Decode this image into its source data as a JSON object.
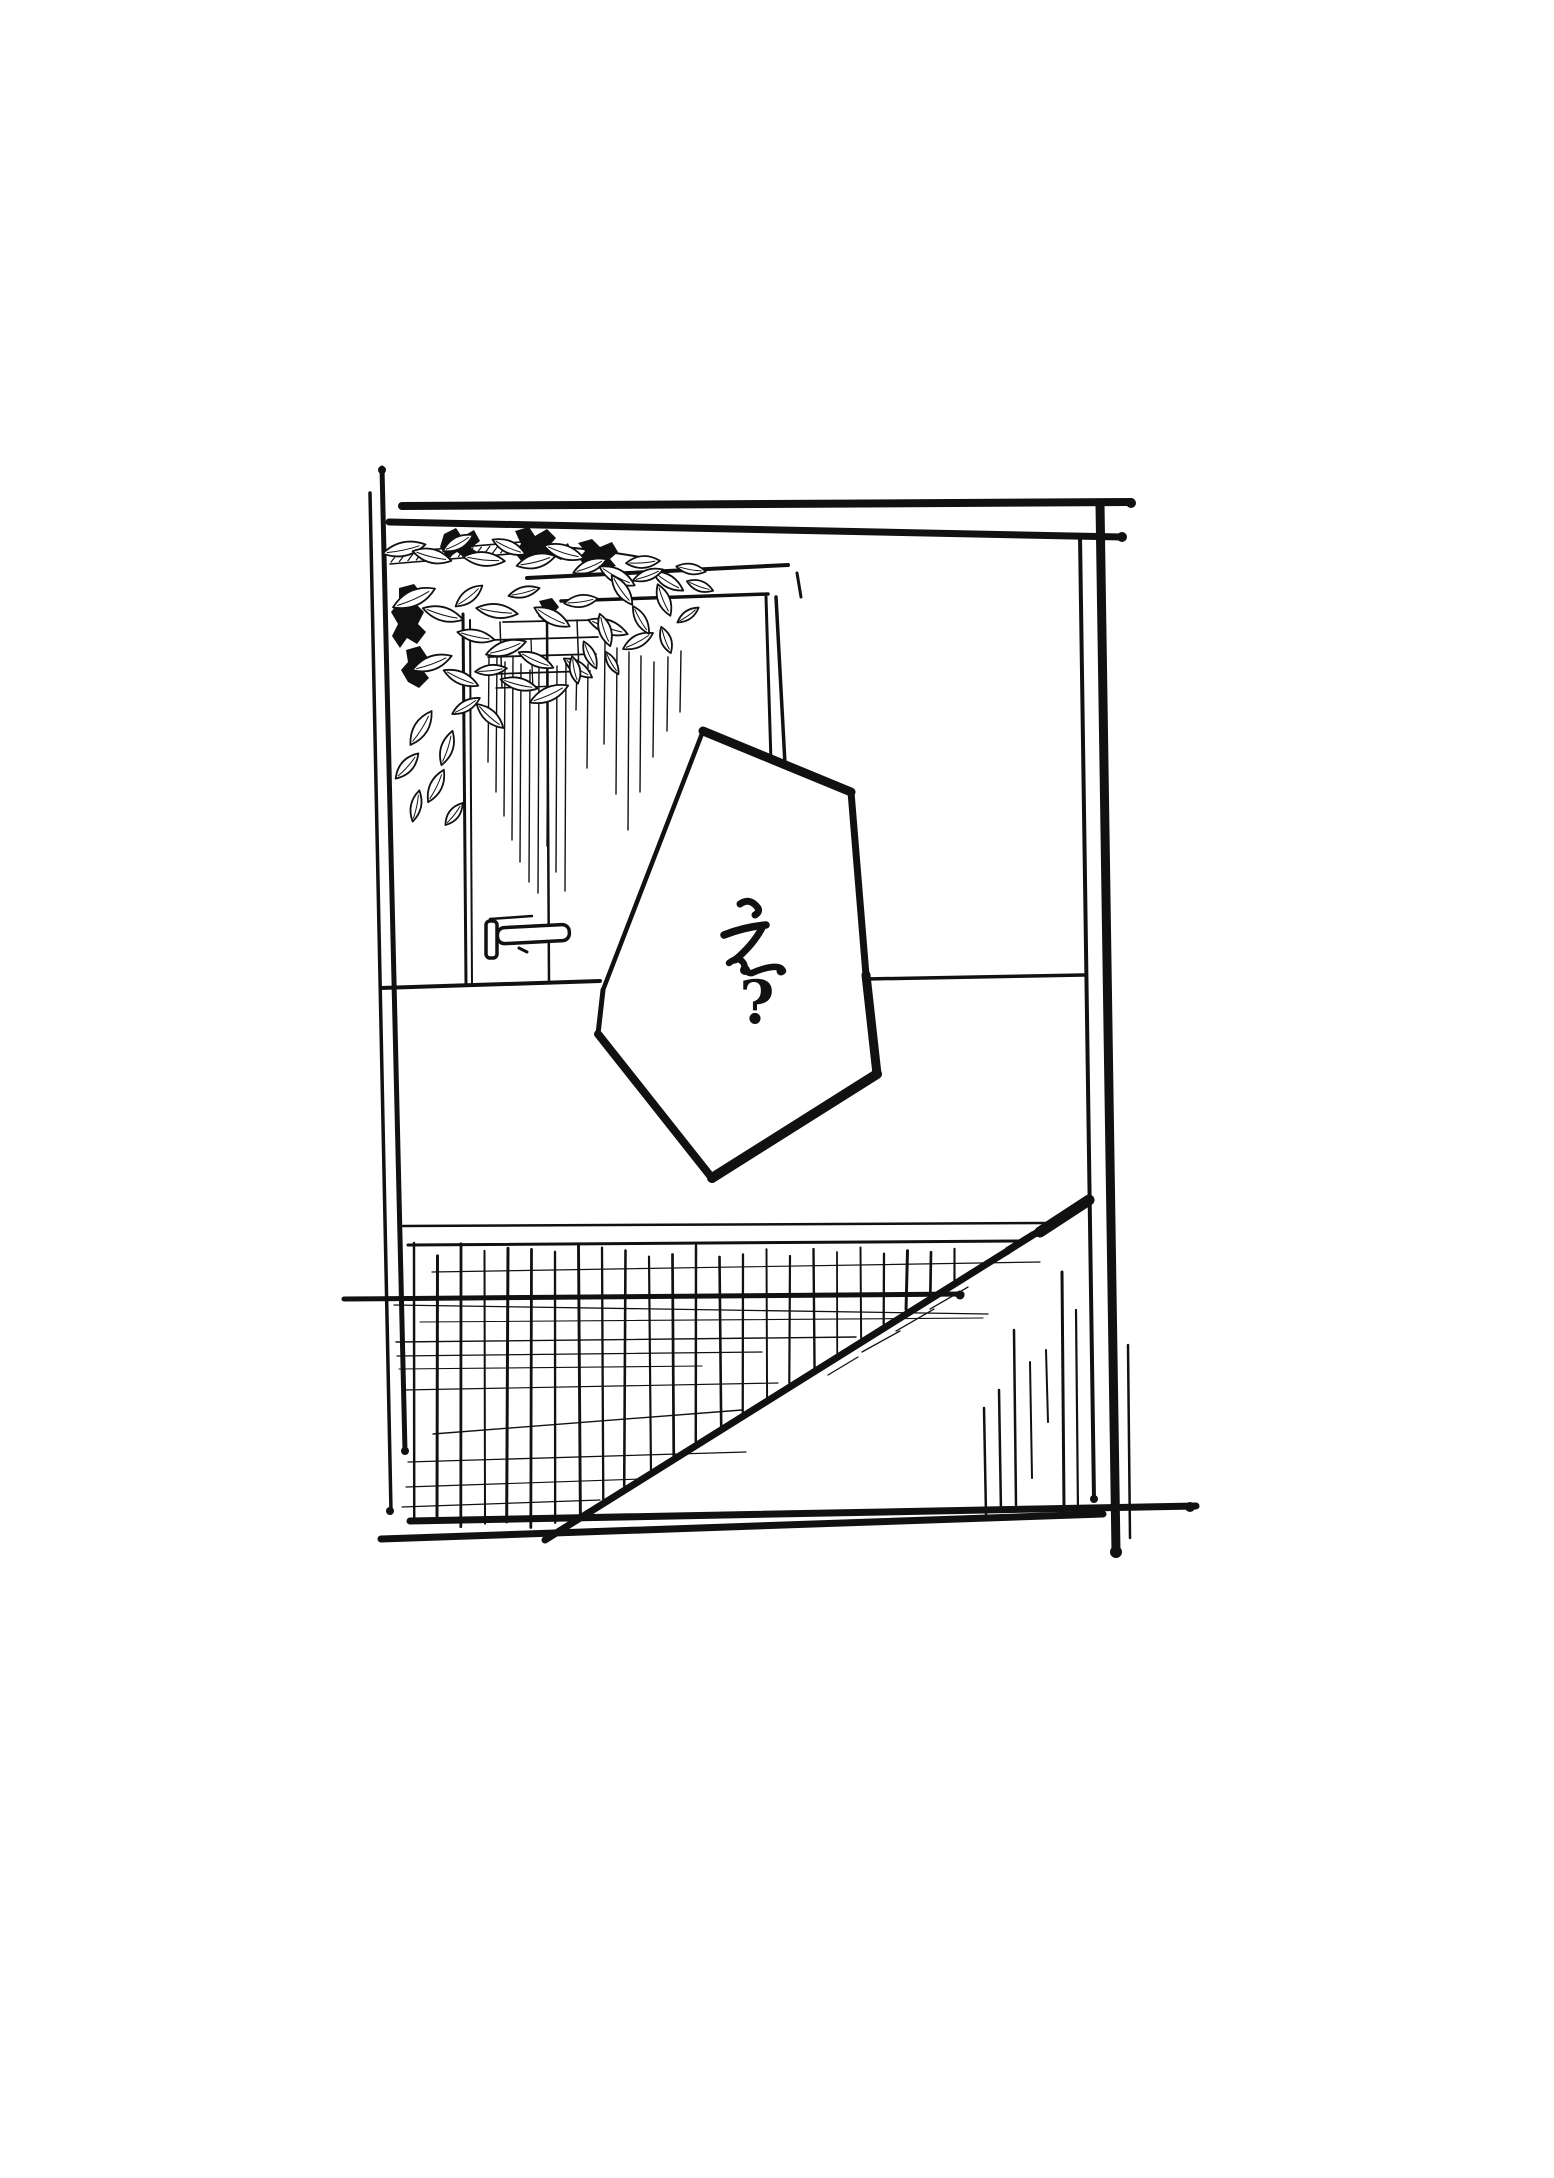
{
  "colors": {
    "ink": "#111111",
    "paper": "#ffffff"
  },
  "bubble": {
    "text": "え?",
    "character": "え",
    "question_mark": "?",
    "points": [
      [
        703,
        731
      ],
      [
        851,
        792
      ],
      [
        866,
        975
      ],
      [
        877,
        1074
      ],
      [
        712,
        1178
      ],
      [
        598,
        1034
      ],
      [
        603,
        990
      ]
    ],
    "edge_widths": [
      9,
      7,
      9,
      10,
      8,
      5,
      4.5
    ],
    "glyph_strokes": [
      {
        "d": "M 740,904 Q 750,897 758,908 Q 760,912 755,915",
        "w": 7
      },
      {
        "d": "M 724,935 Q 744,927 766,925",
        "w": 7.5
      },
      {
        "d": "M 762,928 Q 753,945 735,960",
        "w": 7
      },
      {
        "d": "M 729,963 Q 739,955 744,964 Q 746,974 752,973 Q 763,968 772,967 Q 781,966 783,971",
        "w": 6.5
      }
    ],
    "glyph_dots": [
      [
        745,
        970,
        5
      ],
      [
        781,
        971,
        4.5
      ]
    ],
    "qm_x": 757,
    "qm_y": 1023,
    "qm_size": 60
  },
  "borders": {
    "lines": [
      [
        370,
        493,
        391,
        1511,
        3.5
      ],
      [
        382,
        468,
        405,
        1451,
        5
      ],
      [
        402,
        506,
        1131,
        502,
        8
      ],
      [
        389,
        522,
        1122,
        537,
        7
      ],
      [
        1080,
        536,
        1094,
        1499,
        4
      ],
      [
        1100,
        504,
        1116,
        1552,
        9
      ],
      [
        410,
        1521,
        1196,
        1506,
        7
      ],
      [
        381,
        1539,
        1103,
        1514,
        7
      ]
    ],
    "dots": [
      [
        390,
        1511,
        4
      ],
      [
        405,
        1451,
        4
      ],
      [
        1094,
        1499,
        4
      ],
      [
        1116,
        1552,
        6
      ],
      [
        1190,
        1507,
        5
      ],
      [
        1131,
        503,
        5
      ],
      [
        1122,
        537,
        5
      ],
      [
        382,
        470,
        4
      ]
    ]
  },
  "wall": {
    "lines": [
      [
        527,
        578,
        788,
        565,
        4
      ],
      [
        561,
        601,
        768,
        594,
        3.5
      ],
      [
        766,
        597,
        771,
        762,
        3
      ],
      [
        776,
        597,
        785,
        764,
        3.5
      ],
      [
        797,
        573,
        801,
        597,
        3
      ],
      [
        463,
        614,
        466,
        984,
        3
      ],
      [
        470,
        620,
        472,
        985,
        2
      ],
      [
        547,
        618,
        549,
        983,
        2.5
      ],
      [
        381,
        988,
        600,
        981,
        4
      ],
      [
        866,
        979,
        1084,
        975,
        3.5
      ]
    ]
  },
  "planter": {
    "slats": [
      [
        503,
        622,
        597,
        620,
        1.8
      ],
      [
        490,
        640,
        598,
        637,
        1.8
      ],
      [
        488,
        657,
        596,
        654,
        1.8
      ],
      [
        492,
        674,
        590,
        671,
        1.8
      ],
      [
        496,
        688,
        560,
        686,
        1.5
      ]
    ],
    "verticals": [
      [
        500,
        622,
        502,
        688,
        1.5
      ],
      [
        577,
        620,
        579,
        672,
        1.5
      ],
      [
        531,
        640,
        533,
        690,
        1.3
      ]
    ]
  },
  "streaks": [
    [
      489,
      658,
      762
    ],
    [
      497,
      652,
      792
    ],
    [
      505,
      662,
      816
    ],
    [
      513,
      656,
      840
    ],
    [
      521,
      664,
      862
    ],
    [
      530,
      670,
      882
    ],
    [
      539,
      662,
      893
    ],
    [
      548,
      672,
      846
    ],
    [
      557,
      666,
      872
    ],
    [
      566,
      662,
      891
    ],
    [
      577,
      660,
      710
    ],
    [
      588,
      664,
      768
    ],
    [
      605,
      642,
      744
    ],
    [
      617,
      648,
      794
    ],
    [
      629,
      652,
      830
    ],
    [
      641,
      656,
      792
    ],
    [
      654,
      662,
      757
    ],
    [
      668,
      657,
      731
    ],
    [
      681,
      651,
      712
    ]
  ],
  "foliage": {
    "branch": {
      "x1": 390,
      "y1": 553,
      "x2": 533,
      "y2": 541,
      "width": 11,
      "hatch_count": 16
    },
    "twig": "M 533,545 Q 570,547 600,551 Q 632,555 655,560",
    "blobs": [
      "M444,534 L456,528 L462,537 L474,530 L480,541 L471,548 L479,553 L466,559 L457,552 L448,558 L440,547 Z",
      "M515,531 L529,527 L535,536 L547,529 L556,538 L549,546 L560,549 L568,543 L572,553 L561,560 L551,555 L543,564 L531,557 L522,562 L514,552 L521,544 Z",
      "M578,543 L592,539 L600,547 L612,542 L618,552 L610,559 L616,566 L604,569 L596,563 L586,568 L579,558 L585,551 Z",
      "M399,588 L414,584 L422,594 L416,604 L424,612 L418,624 L426,632 L417,644 L407,638 L400,648 L392,636 L398,624 L391,612 L399,602 Z",
      "M406,650 L420,646 L428,658 L421,668 L429,678 L419,688 L408,682 L401,670 L408,662 Z",
      "M539,601 L552,598 L559,607 L552,615 L558,621 L547,624 L538,616 L543,609 Z"
    ],
    "leaves": [
      [
        404,
        549,
        22,
        8,
        -12
      ],
      [
        432,
        556,
        20,
        8,
        14
      ],
      [
        458,
        543,
        17,
        7,
        -28
      ],
      [
        484,
        559,
        21,
        8,
        6
      ],
      [
        509,
        547,
        18,
        7,
        24
      ],
      [
        536,
        561,
        20,
        8,
        -14
      ],
      [
        564,
        552,
        21,
        8,
        18
      ],
      [
        590,
        566,
        18,
        7,
        -22
      ],
      [
        617,
        576,
        20,
        8,
        28
      ],
      [
        643,
        562,
        17,
        7,
        -4
      ],
      [
        668,
        581,
        18,
        7,
        32
      ],
      [
        691,
        569,
        15,
        6,
        10
      ],
      [
        414,
        598,
        23,
        9,
        -24
      ],
      [
        443,
        614,
        21,
        8,
        16
      ],
      [
        469,
        596,
        17,
        7,
        -38
      ],
      [
        497,
        611,
        21,
        8,
        8
      ],
      [
        524,
        592,
        16,
        6,
        -14
      ],
      [
        552,
        617,
        20,
        8,
        28
      ],
      [
        581,
        601,
        17,
        7,
        -8
      ],
      [
        608,
        627,
        21,
        8,
        20
      ],
      [
        638,
        641,
        17,
        7,
        -28
      ],
      [
        476,
        636,
        19,
        7,
        12
      ],
      [
        506,
        648,
        21,
        8,
        -18
      ],
      [
        536,
        660,
        19,
        7,
        24
      ],
      [
        432,
        663,
        21,
        8,
        -20
      ],
      [
        461,
        678,
        19,
        7,
        24
      ],
      [
        491,
        670,
        16,
        6,
        -6
      ],
      [
        519,
        684,
        19,
        7,
        14
      ],
      [
        549,
        694,
        21,
        8,
        -24
      ],
      [
        578,
        668,
        17,
        7,
        34
      ],
      [
        622,
        590,
        18,
        7,
        55
      ],
      [
        648,
        575,
        16,
        6,
        -20
      ],
      [
        664,
        600,
        17,
        7,
        68
      ],
      [
        641,
        620,
        16,
        6,
        60
      ],
      [
        605,
        630,
        17,
        7,
        72
      ],
      [
        590,
        655,
        15,
        6,
        65
      ],
      [
        575,
        670,
        14,
        6,
        78
      ],
      [
        666,
        640,
        14,
        6,
        70
      ],
      [
        688,
        615,
        13,
        5,
        -35
      ],
      [
        700,
        586,
        14,
        6,
        20
      ],
      [
        612,
        663,
        13,
        5,
        60
      ],
      [
        421,
        728,
        20,
        8,
        -58
      ],
      [
        447,
        748,
        18,
        7,
        -72
      ],
      [
        407,
        766,
        17,
        7,
        -48
      ],
      [
        436,
        786,
        18,
        7,
        -64
      ],
      [
        416,
        806,
        16,
        6,
        -78
      ],
      [
        454,
        814,
        14,
        6,
        -52
      ],
      [
        466,
        706,
        16,
        6,
        -30
      ],
      [
        490,
        716,
        18,
        7,
        42
      ]
    ]
  },
  "handle": {
    "plate": {
      "x": 486,
      "y": 921,
      "w": 11,
      "h": 37,
      "r": 4
    },
    "lever": {
      "x": 497,
      "y": 928,
      "w": 72,
      "h": 16,
      "r": 7,
      "rot": -3
    },
    "top_line": [
      490,
      919,
      532,
      916,
      2.5
    ],
    "hook": [
      519,
      948,
      527,
      952,
      3
    ]
  },
  "floor": {
    "lines": [
      [
        403,
        1226,
        1046,
        1223,
        2.5
      ],
      [
        408,
        1245,
        1020,
        1241,
        3
      ],
      [
        344,
        1299,
        962,
        1294,
        5
      ]
    ],
    "line_dots": [
      [
        960,
        1295,
        4.5
      ]
    ],
    "diagonal": {
      "x1": 1089,
      "y1": 1200,
      "x2": 545,
      "y2": 1540,
      "w": 7,
      "cap": [
        [
          1089,
          1200,
          1040,
          1232,
          11
        ]
      ]
    },
    "hatch": {
      "x_start": 414,
      "x_step": 23.5,
      "count": 24,
      "top": 1250,
      "bottom": 1517
    },
    "needles": [
      [
        984,
        1408,
        1515,
        2.5
      ],
      [
        999,
        1390,
        1512,
        2.5
      ],
      [
        1014,
        1330,
        1505,
        2.5
      ],
      [
        1030,
        1362,
        1478,
        2
      ],
      [
        1046,
        1350,
        1422,
        2
      ],
      [
        1062,
        1272,
        1508,
        3
      ],
      [
        1076,
        1310,
        1512,
        2.2
      ],
      [
        1128,
        1345,
        1538,
        2.5
      ]
    ],
    "sketch_lines": [
      [
        432,
        1272,
        1040,
        1262,
        1.2
      ],
      [
        394,
        1305,
        988,
        1314,
        1.3
      ],
      [
        420,
        1322,
        983,
        1318,
        1.1
      ],
      [
        396,
        1342,
        856,
        1337,
        1.4
      ],
      [
        397,
        1356,
        762,
        1352,
        1.2
      ],
      [
        399,
        1369,
        702,
        1366,
        1.1
      ],
      [
        403,
        1390,
        778,
        1383,
        1.2
      ],
      [
        433,
        1434,
        742,
        1410,
        1.4
      ],
      [
        408,
        1462,
        746,
        1452,
        1.3
      ],
      [
        406,
        1487,
        642,
        1479,
        1.2
      ],
      [
        402,
        1507,
        600,
        1500,
        1.2
      ]
    ],
    "cross_ticks": [
      [
        862,
        1352,
        900,
        1331
      ],
      [
        896,
        1331,
        934,
        1309
      ],
      [
        930,
        1309,
        968,
        1287
      ],
      [
        976,
        1273,
        1010,
        1253
      ],
      [
        828,
        1375,
        858,
        1357
      ],
      [
        1006,
        1248,
        1032,
        1232
      ]
    ]
  }
}
